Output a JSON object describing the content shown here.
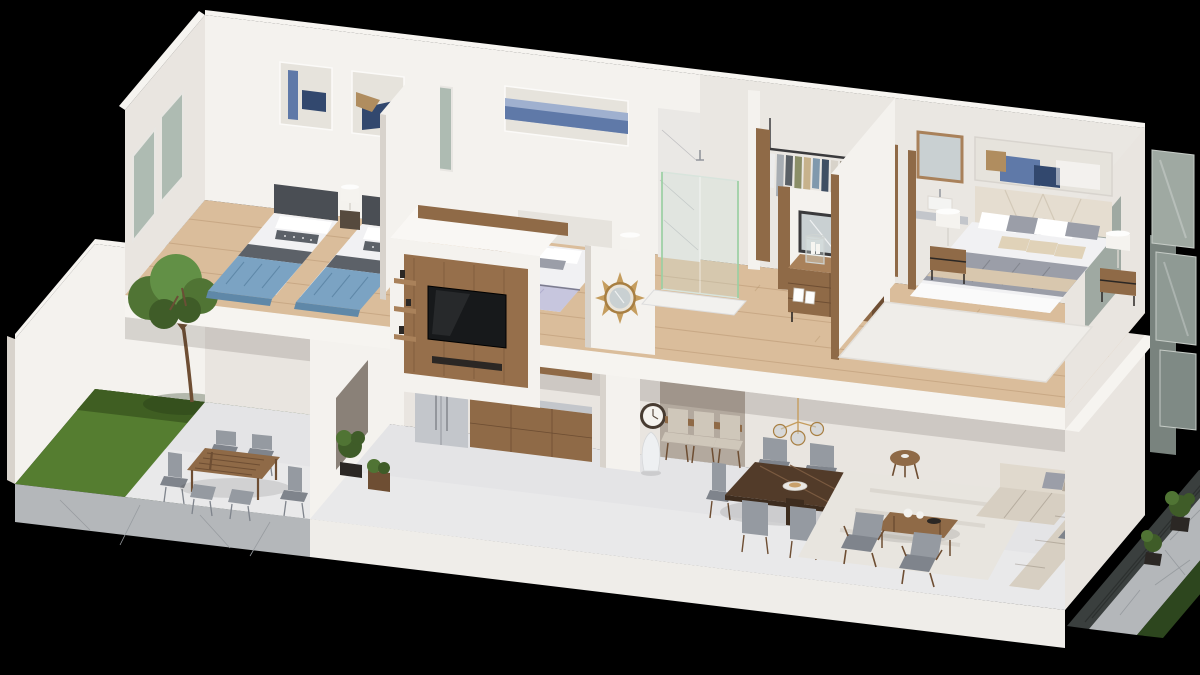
{
  "scene": {
    "type": "3d-isometric-cutaway-house-rendering",
    "background": "black",
    "floors": [
      {
        "name": "upper-floor",
        "rooms": [
          {
            "name": "kids-bedroom",
            "furniture": [
              "twin bed with blue blanket x2",
              "dark headboards",
              "patterned accent pillows",
              "nightstand",
              "white drum table lamp",
              "abstract wall art x2",
              "frosted window x2",
              "window in back wall"
            ]
          },
          {
            "name": "hallway",
            "furniture": [
              "white TV partition unit",
              "wood media panel",
              "flat-screen TV",
              "soundbar",
              "display shelves",
              "round sunburst mirror"
            ]
          },
          {
            "name": "bedroom-2",
            "furniture": [
              "double bed with white bedding",
              "lavender foot blanket",
              "upholstered headboard",
              "blue landscape wall art",
              "nightstand x2",
              "white drum table lamp x2"
            ]
          },
          {
            "name": "bathroom",
            "furniture": [
              "marble wall panel",
              "glass shower enclosure",
              "shower head",
              "white shower tray"
            ]
          },
          {
            "name": "walk-in-closet",
            "furniture": [
              "black clothes rail",
              "hanging clothes x13",
              "wood side panels"
            ]
          },
          {
            "name": "dressing-area",
            "furniture": [
              "wood dresser",
              "black framed mirror",
              "glass hurricane candle holders x2",
              "white candles",
              "photo frames"
            ]
          },
          {
            "name": "master-bedroom",
            "furniture": [
              "double bed",
              "cream upholstered headboard",
              "wide abstract wall art",
              "gray blanket",
              "beige throw",
              "beige accent pillows x3",
              "metal-frame wood nightstand x2",
              "white drum table lamp x2",
              "white area rug",
              "vanity sink",
              "wood framed mirror"
            ]
          }
        ]
      },
      {
        "name": "ground-floor",
        "rooms": [
          {
            "name": "courtyard",
            "furniture": [
              "lawn",
              "tree",
              "white boundary walls",
              "stone patio",
              "outdoor wood slat dining table",
              "gray outdoor chair x6",
              "planter boxes",
              "potted plant in doorway"
            ]
          },
          {
            "name": "kitchen",
            "furniture": [
              "stainless refrigerator",
              "wood wall cabinet",
              "upper cabinets",
              "base cabinets",
              "gray countertop",
              "stainless sink"
            ]
          },
          {
            "name": "dining-room",
            "furniture": [
              "white structural column",
              "round wall clock",
              "white floor vase",
              "breakfast counter",
              "beige counter chair x3",
              "walnut dining table",
              "white plate",
              "gray dining chair x6",
              "brass and glass chandelier",
              "round wood side table"
            ]
          },
          {
            "name": "living-room",
            "furniture": [
              "light area rug",
              "wood coffee table",
              "white jars",
              "dark bowl",
              "gray wood-frame armchair x2",
              "beige corner sofa",
              "gray accent pillows"
            ]
          },
          {
            "name": "front-yard",
            "furniture": [
              "dark glass facade",
              "stone path",
              "dark green hedge",
              "potted palm plant x2",
              "gray glass panel x3"
            ]
          }
        ]
      }
    ]
  },
  "palette": {
    "bg": "#000000",
    "wallLight": "#f4f2ee",
    "wallMid": "#e9e5e0",
    "wallShade": "#d8d3cc",
    "slabWhite": "#f6f4f0",
    "woodFloor": "#dabd9b",
    "woodFloorLine": "#b99872",
    "wood": "#8f6a47",
    "woodLight": "#a9815a",
    "woodDark": "#6e4e33",
    "walnut": "#523b29",
    "walnutLight": "#7a5a40",
    "steel": "#c3c6cb",
    "steelDark": "#93969c",
    "glassGreen": "#aebbb2",
    "pane": "#9fa9a2",
    "paneDark": "#79837e",
    "marble": "#eae8e5",
    "grass": "#557d30",
    "grassDark": "#3f5e22",
    "foliage": "#507434",
    "foliageLight": "#629046",
    "foliageDark": "#3f5c28",
    "trunk": "#6b4f36",
    "stone": "#b4b7ba",
    "stoneDark": "#989ca0",
    "hedge": "#2d461e",
    "facade": "#3a3f3e",
    "blue": "#7ba3c3",
    "blueDark": "#5f88a8",
    "grayThrow": "#5c6168",
    "headboard": "#4a4e54",
    "bedding": "#f1f1f3",
    "lavender": "#c7c6de",
    "lavenderDark": "#b0aecd",
    "artBlue": "#5f79a8",
    "artNavy": "#32486e",
    "artTan": "#b08d5f",
    "artBase": "#e6e3dc",
    "sofa": "#d7cfc2",
    "sofaLight": "#e0d9cd",
    "sofaDark": "#c2b9aa",
    "chairGray": "#959aa1",
    "chairGrayDark": "#7f848c",
    "chairBeige": "#cfc7ba",
    "rug": "#e8e5df",
    "gold": "#c59d5e",
    "goldDark": "#a87f42",
    "clockRim": "#473b31",
    "floorLower": "#e4e4e6",
    "plinth": "#efede9",
    "lamp": "#f5f3ef",
    "pillowBeige": "#e0d2b8",
    "blanketGray": "#9b9ea8",
    "throwBeige": "#d8c7ae",
    "tv": "#17191b",
    "darkObj": "#2b2724",
    "mirror": "#c9d0d2",
    "rail": "#3a3a3c",
    "clothes": [
      "#ececec",
      "#a7adb3",
      "#5a6066",
      "#8b8f68",
      "#c7b28c",
      "#8099ad",
      "#3f4f63",
      "#d8d3ca",
      "#9a9387",
      "#b5c2cf",
      "#6d7478",
      "#e2ddd4",
      "#7d8b99"
    ]
  }
}
